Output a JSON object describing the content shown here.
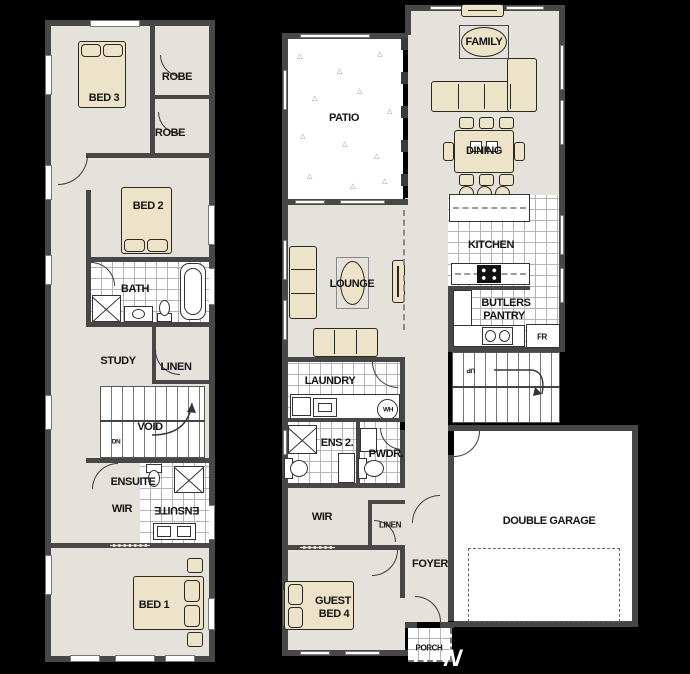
{
  "title": "Two storey house floor plan",
  "colors": {
    "background": "#000000",
    "wall": "#474747",
    "floor": "#e5e2db",
    "tile": "#ffffff",
    "tile_line": "#b5b5b5",
    "furniture": "#ece3c8",
    "outline": "#2a2822",
    "label": "#141414"
  },
  "upper_floor": {
    "bed3": "BED 3",
    "robe_top": "ROBE",
    "robe_bottom": "ROBE",
    "bed2": "BED 2",
    "bath": "BATH",
    "study": "STUDY",
    "linen": "LINEN",
    "void": "VOID",
    "down": "DN",
    "ensuite": "ENSUITE",
    "ensuite_mirrored": "ENSUITE",
    "wir": "WIR",
    "bed1": "BED 1"
  },
  "ground_floor": {
    "patio": "PATIO",
    "lounge": "LOUNGE",
    "laundry": "LAUNDRY",
    "water_heater": "WH",
    "ens2": "ENS 2.",
    "powder": "PWDR.",
    "wir": "WIR",
    "linen": "LINEN",
    "guest_line1": "GUEST",
    "guest_line2": "BED 4",
    "foyer": "FOYER",
    "porch": "PORCH",
    "family": "FAMILY",
    "dining": "DINING",
    "kitchen": "KITCHEN",
    "butlers_line1": "BUTLERS",
    "butlers_line2": "PANTRY",
    "fridge": "FR",
    "up": "UP",
    "garage": "DOUBLE GARAGE"
  },
  "compass": {
    "north": "N"
  }
}
